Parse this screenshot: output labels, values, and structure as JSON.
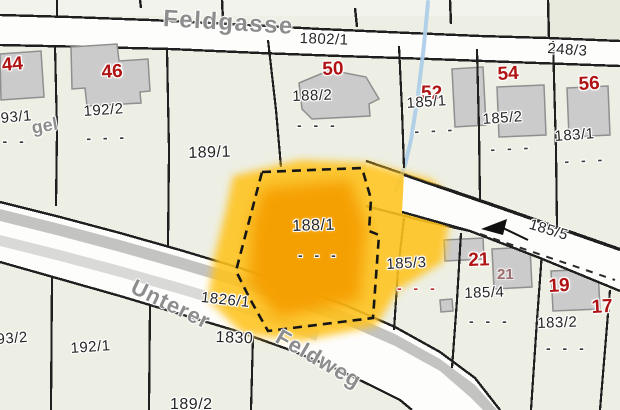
{
  "map_type": "cadastral-parcel-map",
  "highlighted_parcel": "188/1",
  "streets": {
    "feldgasse": "Feldgasse",
    "unterer": "Unterer",
    "feldweg": "Feldweg",
    "left_fragment": "gel"
  },
  "roads": {
    "r1802_1": "1802/1",
    "r248_3": "248/3",
    "r185_5": "185/5",
    "r1826_1": "1826/1",
    "r1830": "1830"
  },
  "parcels": {
    "p93_1": "93/1",
    "p192_2": "192/2",
    "p189_1": "189/1",
    "p188_2": "188/2",
    "p185_1": "185/1",
    "p185_2": "185/2",
    "p183_1": "183/1",
    "p188_1": "188/1",
    "p185_3": "185/3",
    "p185_4": "185/4",
    "p183_2": "183/2",
    "p192_1": "192/1",
    "p93_2": "93/2",
    "p189_2": "189/2"
  },
  "house_numbers": {
    "h44": "44",
    "h46": "46",
    "h50": "50",
    "h52": "52",
    "h54": "54",
    "h56": "56",
    "h21": "21",
    "h21_faint": "21",
    "h19": "19",
    "h17": "17"
  },
  "marks": {
    "dashes": "- - -",
    "red_dashes": "- - -"
  },
  "colors": {
    "highlight_core": "#F59E00",
    "highlight_glow": "#FFC31C",
    "road_fill": "#FDFDFB",
    "road_gray": "#B4B4B4",
    "parcel_bg": "#EDEFE4",
    "boundary": "#1F1F1F",
    "building_fill": "#CBCBCB",
    "house_number_red": "#B01313",
    "label_dark": "#262626",
    "street_gray": "#8D8D8D",
    "stream_blue": "#AECDE8"
  }
}
